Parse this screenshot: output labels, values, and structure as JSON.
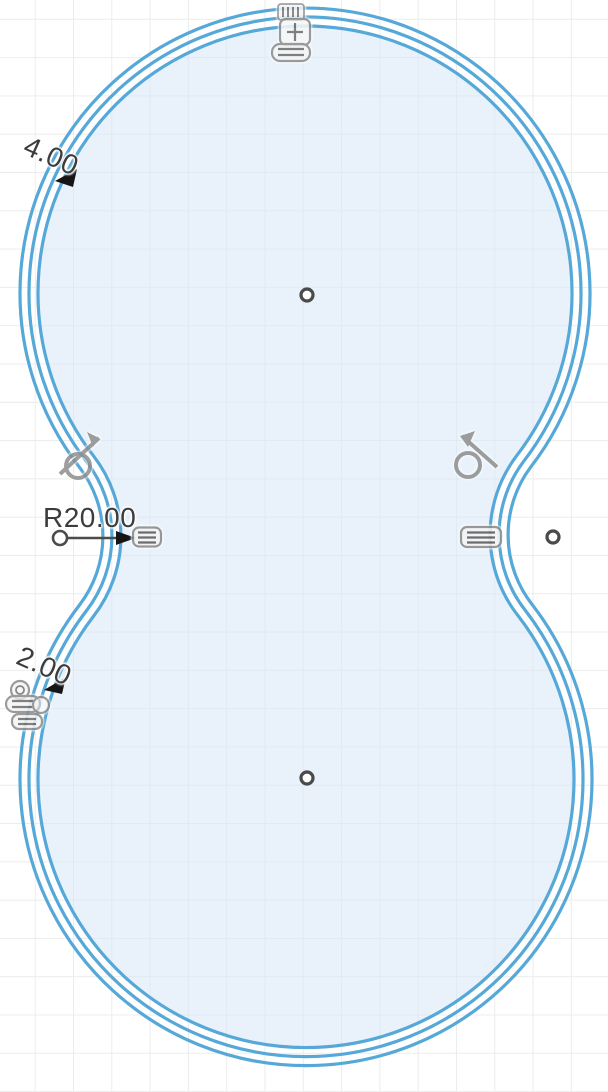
{
  "app": {
    "type": "cad-sketch-canvas"
  },
  "canvas": {
    "width_px": 608,
    "height_px": 1092,
    "background_color": "#ffffff",
    "grid_color": "#ececec",
    "grid_spacing_px": 38.3
  },
  "sketch": {
    "profile": {
      "shape": "peanut-two-circles-with-waist-fillets",
      "curve_count": 3,
      "curve_color": "#56a8d8",
      "fill_color": "#e9f2fa"
    },
    "dimensions": [
      {
        "id": "offset-top",
        "label": "4.00",
        "rotation_deg": 24
      },
      {
        "id": "waist-radius",
        "label": "R20.00",
        "rotation_deg": 0
      },
      {
        "id": "offset-bottom",
        "label": "2.00",
        "rotation_deg": 24
      }
    ],
    "points": [
      {
        "id": "top-circle-center"
      },
      {
        "id": "bottom-circle-center"
      },
      {
        "id": "right-waist-point"
      }
    ],
    "constraints": [
      {
        "id": "tangent-left",
        "icon": "tangent-icon"
      },
      {
        "id": "tangent-right",
        "icon": "tangent-icon"
      },
      {
        "id": "equal-left",
        "icon": "equal-constraint-icon"
      },
      {
        "id": "equal-right",
        "icon": "equal-constraint-icon"
      },
      {
        "id": "stack-top",
        "icon": "constraint-stack-icon"
      },
      {
        "id": "stack-bottom-left",
        "icon": "constraint-stack-icon"
      }
    ],
    "colors": {
      "dimension_text": "#3c3c3c",
      "leader_gray": "#4c4c4c",
      "arrow_black": "#151515",
      "icon_gray": "#8e8e8e"
    }
  }
}
